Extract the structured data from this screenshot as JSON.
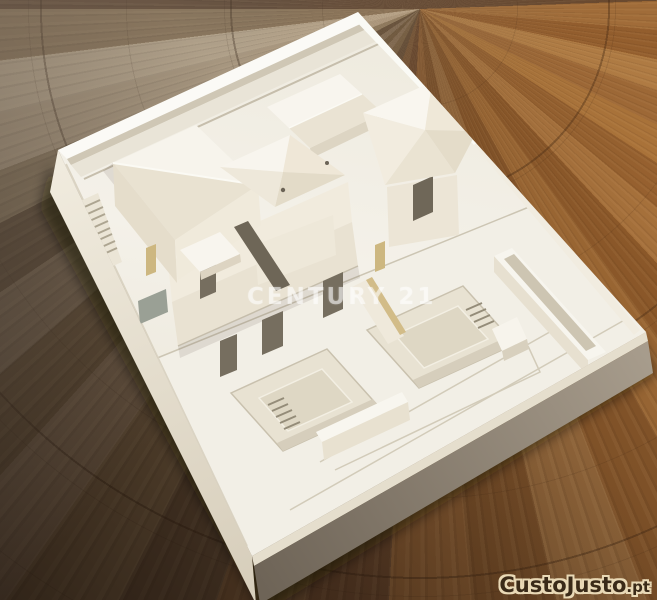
{
  "watermarks": {
    "center": {
      "text": "CENTURY 21",
      "color": "rgba(255,255,255,0.52)"
    },
    "corner": {
      "brand": "CustoJusto",
      "tld": ".pt",
      "fill": "#3a2a18",
      "outline": "#e9d9b6"
    }
  },
  "palette": {
    "model_white": "#f2efe6",
    "model_roof_light": "#f8f5ee",
    "model_roof_shade": "#e6dfcf",
    "model_base_dark_side": "#8d8274",
    "model_tan_accent": "#d2bc88",
    "model_opening_dark": "#756d5e",
    "floor_warm_brown": "#9a6b3b",
    "floor_dark_brown": "#5f412a",
    "floor_pale_plank": "#b3a085"
  }
}
